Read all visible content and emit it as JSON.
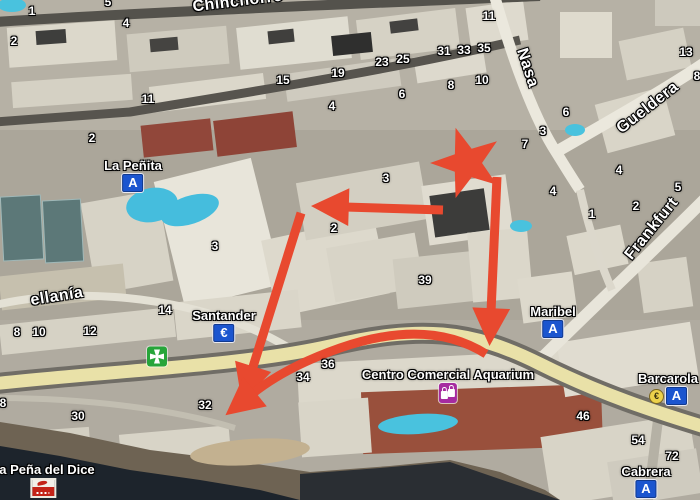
{
  "map": {
    "description_visible": false,
    "colors": {
      "route_red": "#e8492f",
      "badge_blue": "#1b55cf",
      "pharmacy_green": "#27a53a",
      "shopping_magenta": "#a62ba0",
      "euro_yellow": "#ecd14b",
      "main_road_yellow": "#e9e1a8"
    }
  },
  "streets": [
    {
      "label": "Chinchorro",
      "x": 238,
      "y": 2,
      "rotate": -7
    },
    {
      "label": "Nasa",
      "x": 527,
      "y": 68,
      "rotate": 72
    },
    {
      "label": "Gueldera",
      "x": 648,
      "y": 108,
      "rotate": -38
    },
    {
      "label": "Frankfurt",
      "x": 652,
      "y": 229,
      "rotate": -51
    },
    {
      "label": "ellanía",
      "x": 57,
      "y": 297,
      "rotate": -9
    }
  ],
  "places": [
    {
      "label": "La Peñita",
      "badge": "A",
      "badge_type": "blue",
      "x": 133,
      "y": 168
    },
    {
      "label": "Santander",
      "badge": "€",
      "badge_type": "blue",
      "x": 224,
      "y": 318
    },
    {
      "label": "Maribel",
      "badge": "A",
      "badge_type": "blue",
      "x": 553,
      "y": 314
    },
    {
      "label": "Barcarola",
      "badge": "A",
      "badge_type": "blue",
      "extra_badge": "€",
      "x": 668,
      "y": 381
    },
    {
      "label": "Cabrera",
      "badge": "A",
      "badge_type": "blue",
      "x": 646,
      "y": 474
    },
    {
      "label": "Centro Comercial Aquarium",
      "badge": "",
      "badge_type": "shopping",
      "x": 448,
      "y": 377
    },
    {
      "label": "La Peña del Dice",
      "badge": "",
      "badge_type": "flag",
      "x": 43,
      "y": 472
    },
    {
      "label": "",
      "badge": "",
      "badge_type": "pharmacy",
      "x": 157,
      "y": 356
    }
  ],
  "house_numbers": [
    {
      "v": "1",
      "x": 32,
      "y": 11
    },
    {
      "v": "5",
      "x": 108,
      "y": 2
    },
    {
      "v": "4",
      "x": 126,
      "y": 23
    },
    {
      "v": "2",
      "x": 14,
      "y": 41
    },
    {
      "v": "11",
      "x": 148,
      "y": 99
    },
    {
      "v": "15",
      "x": 283,
      "y": 80
    },
    {
      "v": "19",
      "x": 338,
      "y": 73
    },
    {
      "v": "23",
      "x": 382,
      "y": 62
    },
    {
      "v": "25",
      "x": 403,
      "y": 59
    },
    {
      "v": "31",
      "x": 444,
      "y": 51
    },
    {
      "v": "33",
      "x": 464,
      "y": 50
    },
    {
      "v": "35",
      "x": 484,
      "y": 48
    },
    {
      "v": "11",
      "x": 489,
      "y": 16
    },
    {
      "v": "10",
      "x": 482,
      "y": 80
    },
    {
      "v": "8",
      "x": 451,
      "y": 85
    },
    {
      "v": "6",
      "x": 402,
      "y": 94
    },
    {
      "v": "4",
      "x": 332,
      "y": 106
    },
    {
      "v": "13",
      "x": 686,
      "y": 52
    },
    {
      "v": "8",
      "x": 697,
      "y": 76
    },
    {
      "v": "6",
      "x": 566,
      "y": 112
    },
    {
      "v": "3",
      "x": 543,
      "y": 131
    },
    {
      "v": "7",
      "x": 525,
      "y": 144
    },
    {
      "v": "2",
      "x": 92,
      "y": 138
    },
    {
      "v": "3",
      "x": 215,
      "y": 246
    },
    {
      "v": "3",
      "x": 386,
      "y": 178
    },
    {
      "v": "2",
      "x": 334,
      "y": 228
    },
    {
      "v": "39",
      "x": 425,
      "y": 280
    },
    {
      "v": "4",
      "x": 619,
      "y": 170
    },
    {
      "v": "4",
      "x": 553,
      "y": 191
    },
    {
      "v": "1",
      "x": 592,
      "y": 214
    },
    {
      "v": "2",
      "x": 636,
      "y": 206
    },
    {
      "v": "5",
      "x": 678,
      "y": 187
    },
    {
      "v": "14",
      "x": 165,
      "y": 310
    },
    {
      "v": "12",
      "x": 90,
      "y": 331
    },
    {
      "v": "10",
      "x": 39,
      "y": 332
    },
    {
      "v": "8",
      "x": 17,
      "y": 332
    },
    {
      "v": "8",
      "x": 3,
      "y": 403
    },
    {
      "v": "30",
      "x": 78,
      "y": 416
    },
    {
      "v": "32",
      "x": 205,
      "y": 405
    },
    {
      "v": "36",
      "x": 328,
      "y": 364
    },
    {
      "v": "34",
      "x": 303,
      "y": 377
    },
    {
      "v": "46",
      "x": 583,
      "y": 416
    },
    {
      "v": "54",
      "x": 638,
      "y": 440
    },
    {
      "v": "72",
      "x": 672,
      "y": 456
    }
  ]
}
